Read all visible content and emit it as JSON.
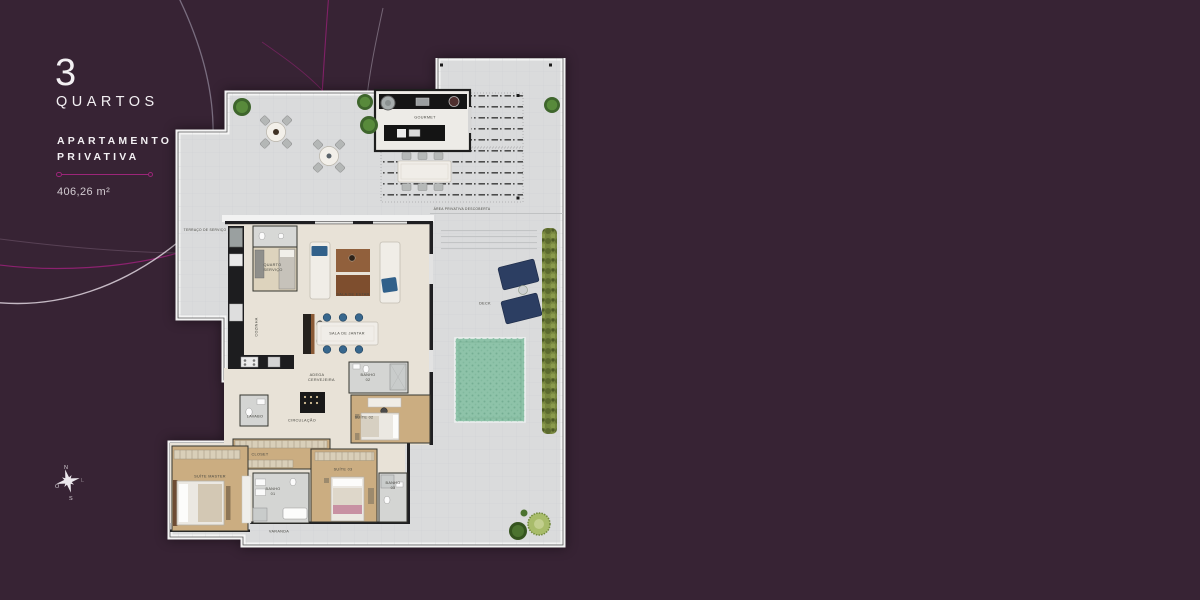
{
  "theme": {
    "background_color": "#372334",
    "accent_magenta": "#9c2579",
    "plan_slab_color": "#dadbdc",
    "pool_color": "#8ec3a9",
    "lounger_color": "#2c3e62",
    "text_color": "#f3f0f3"
  },
  "sidebar": {
    "bedrooms_number": "3",
    "bedrooms_label": "QUARTOS",
    "unit_type_line1": "APARTAMENTO",
    "unit_type_line2": "PRIVATIVA",
    "area": "406,26 m²"
  },
  "compass": {
    "north": "N",
    "south": "S",
    "east": "L",
    "west": "O"
  },
  "floor_plan": {
    "rooms": [
      {
        "id": "terraco-servico",
        "name": "TERRAÇO DE SERVIÇO"
      },
      {
        "id": "gourmet",
        "name": "GOURMET"
      },
      {
        "id": "area-privativa",
        "name": "ÁREA PRIVATIVA DESCOBERTA"
      },
      {
        "id": "deck",
        "name": "DECK"
      },
      {
        "id": "quarto-servico",
        "name": "QUARTO SERVIÇO"
      },
      {
        "id": "cozinha",
        "name": "COZINHA"
      },
      {
        "id": "sala-de-estar",
        "name": "SALA DE ESTAR"
      },
      {
        "id": "sala-de-jantar",
        "name": "SALA DE JANTAR"
      },
      {
        "id": "adega",
        "name": "ADEGA CERVEJEIRA"
      },
      {
        "id": "lavabo",
        "name": "LAVABO"
      },
      {
        "id": "circulacao",
        "name": "CIRCULAÇÃO"
      },
      {
        "id": "banho-02",
        "name": "BANHO 02"
      },
      {
        "id": "suite-02",
        "name": "SUÍTE 02"
      },
      {
        "id": "closet",
        "name": "CLOSET"
      },
      {
        "id": "suite-master",
        "name": "SUÍTE MASTER"
      },
      {
        "id": "banho-01",
        "name": "BANHO 01"
      },
      {
        "id": "suite-03",
        "name": "SUÍTE 03"
      },
      {
        "id": "banho-03",
        "name": "BANHO 03"
      },
      {
        "id": "varanda",
        "name": "VARANDA"
      }
    ]
  }
}
